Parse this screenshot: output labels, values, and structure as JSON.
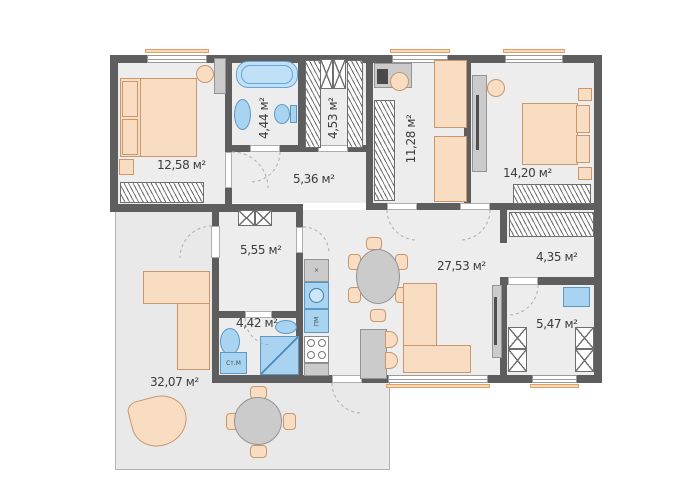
{
  "plan": {
    "title": "apartment-floor-plan",
    "rooms": [
      {
        "id": "bedroom-left",
        "area": "12,58 м²"
      },
      {
        "id": "bathroom-main",
        "area": "4,44 м²"
      },
      {
        "id": "dressing-top",
        "area": "4,53 м²"
      },
      {
        "id": "corridor",
        "area": "5,36 м²"
      },
      {
        "id": "kids-room",
        "area": "11,28 м²"
      },
      {
        "id": "bedroom-right",
        "area": "14,20 м²"
      },
      {
        "id": "hall",
        "area": "5,55 м²"
      },
      {
        "id": "bathroom-small",
        "area": "4,42 м²"
      },
      {
        "id": "living-kitchen",
        "area": "27,53 м²"
      },
      {
        "id": "wardrobe-right",
        "area": "4,35 м²"
      },
      {
        "id": "utility-room",
        "area": "5,47 м²"
      },
      {
        "id": "terrace",
        "area": "32,07 м²"
      }
    ],
    "appliances": {
      "washing_machine": "Ст.М",
      "dishwasher": "ПМ",
      "hood_symbol": "×"
    },
    "colors": {
      "wall": "#5e5e5e",
      "floor": "#ededed",
      "terrace": "#e9e9e9",
      "furniture": "#f9ddc2",
      "plumbing": "#a9d4f1",
      "window_sill": "#f7d9b8"
    }
  }
}
